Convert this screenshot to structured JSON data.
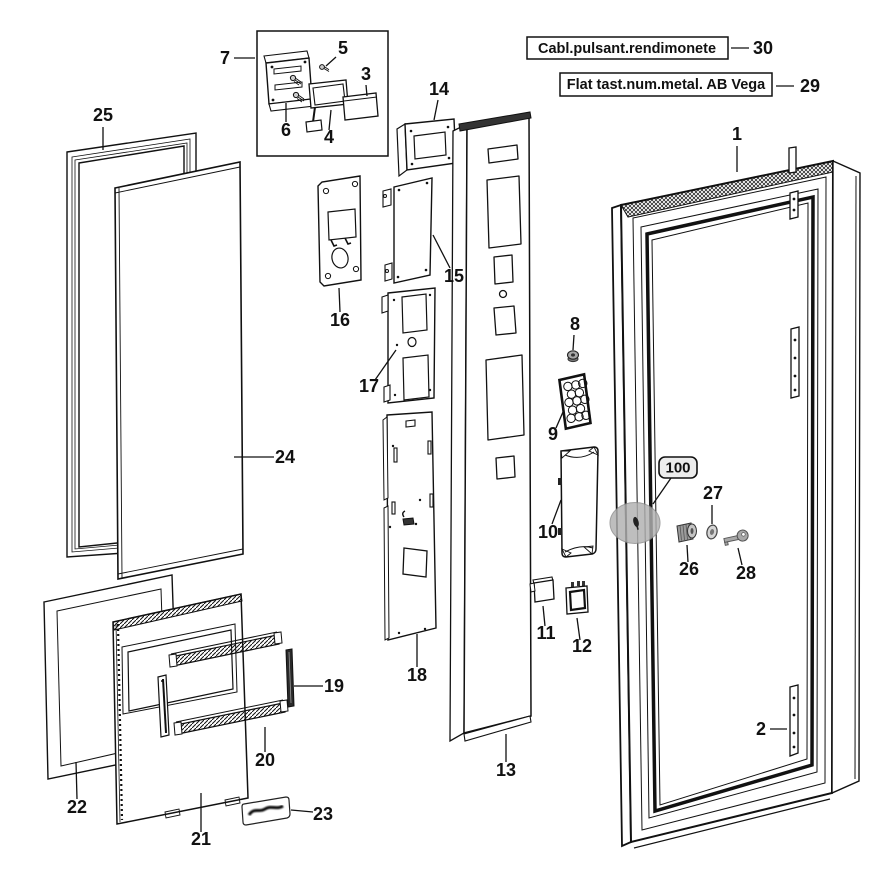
{
  "diagram_title": "Exploded parts diagram - vending machine door assembly",
  "boxed_labels": [
    {
      "text": "Cabl.pulsant.rendimonete",
      "number": "30"
    },
    {
      "text": "Flat tast.num.metal. AB Vega",
      "number": "29"
    }
  ],
  "callouts": {
    "n1": "1",
    "n2": "2",
    "n3": "3",
    "n4": "4",
    "n5": "5",
    "n6": "6",
    "n7": "7",
    "n8": "8",
    "n9": "9",
    "n10": "10",
    "n11": "11",
    "n12": "12",
    "n13": "13",
    "n14": "14",
    "n15": "15",
    "n16": "16",
    "n17": "17",
    "n18": "18",
    "n19": "19",
    "n20": "20",
    "n21": "21",
    "n22": "22",
    "n23": "23",
    "n24": "24",
    "n25": "25",
    "n26": "26",
    "n27": "27",
    "n28": "28",
    "n29": "29",
    "n30": "30",
    "n100": "100"
  },
  "colors": {
    "line": "#111111",
    "lock_highlight": "#b0b0b0",
    "metal_gray": "#9a9a9a",
    "background": "#ffffff"
  }
}
